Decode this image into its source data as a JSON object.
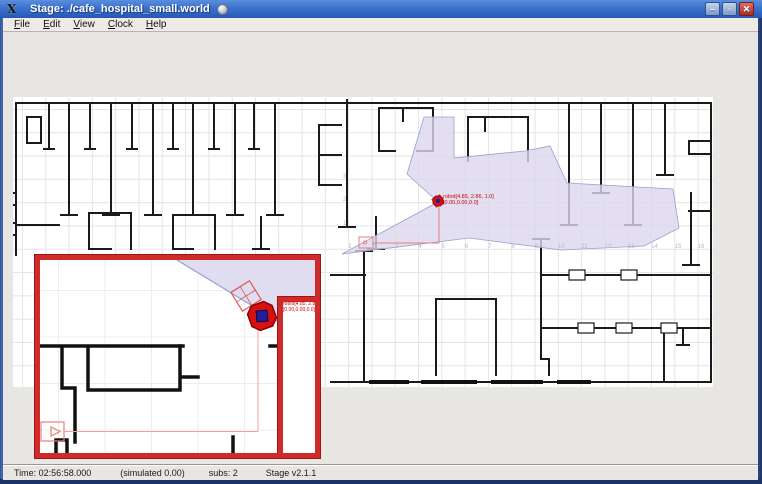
{
  "window": {
    "title": "Stage: ./cafe_hospital_small.world"
  },
  "titlebar": {
    "buttons": [
      {
        "name": "minimize",
        "glyph": "–"
      },
      {
        "name": "maximize",
        "glyph": "▫"
      },
      {
        "name": "close",
        "glyph": "✕"
      }
    ],
    "x11_logo_glyph": "X"
  },
  "menu": {
    "items": [
      {
        "label": "File"
      },
      {
        "label": "Edit"
      },
      {
        "label": "View"
      },
      {
        "label": "Clock"
      },
      {
        "label": "Help"
      }
    ]
  },
  "robot": {
    "name_line": "robot[4.85, 2.86, 1.0]",
    "pose_line": "[0.00,0.00,0.0]"
  },
  "axis": {
    "x_labels": [
      "1",
      "2",
      "3",
      "4",
      "5",
      "6",
      "7",
      "8",
      "9",
      "10",
      "11",
      "12",
      "13",
      "14",
      "15",
      "16"
    ],
    "y_labels": [
      "1",
      "2",
      "3"
    ]
  },
  "statusbar": {
    "time": "Time: 02:56:58.000",
    "simulated": "(simulated 0.00)",
    "subs": "subs: 2",
    "version": "Stage v2.1.1"
  },
  "colors": {
    "titlebar_blue": "#3b71cc",
    "frame_navy": "#1d3367",
    "wall_black": "#1a1a1a",
    "laser_fan_fill": "#dcd7ee",
    "laser_fan_edge": "#93a2cf",
    "robot_red": "#d51212",
    "robot_blue": "#1f1f9e",
    "annotation_red": "#e87f7f",
    "inset_border_red": "#cf2b2b"
  }
}
